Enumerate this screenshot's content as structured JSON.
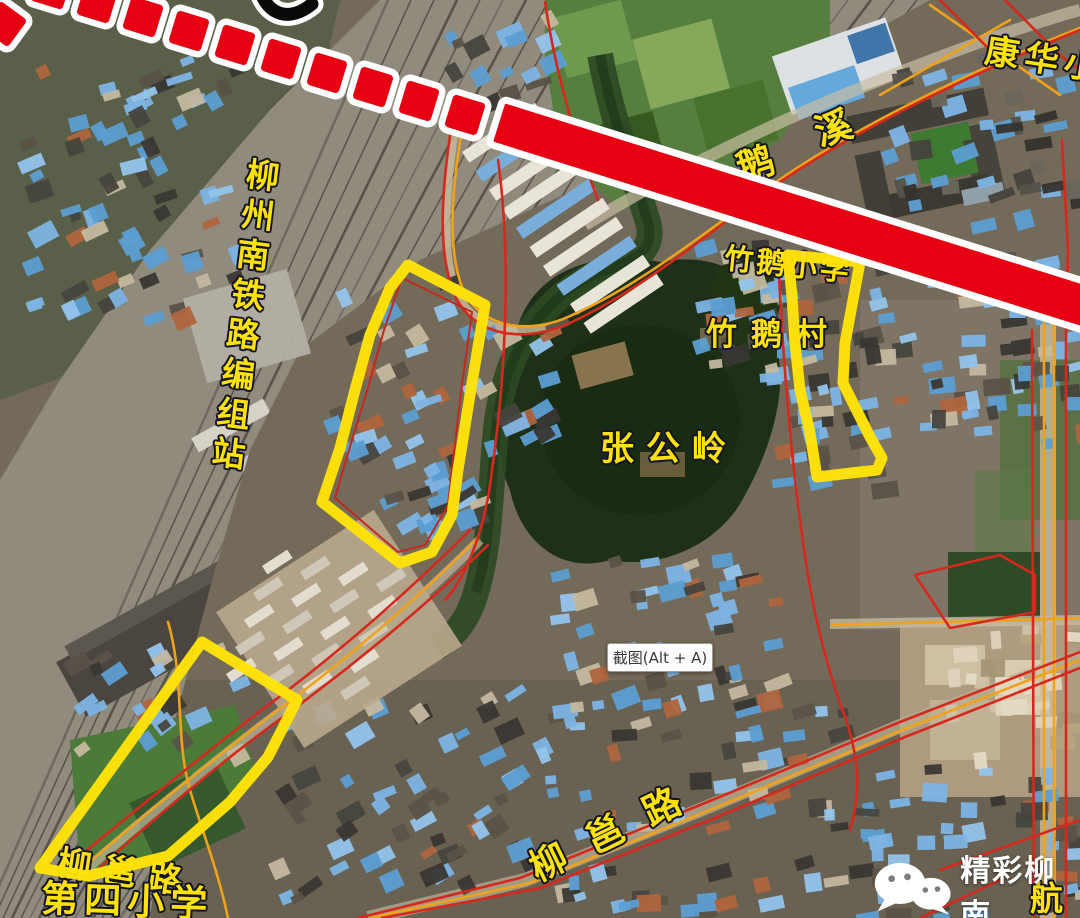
{
  "map": {
    "labels": {
      "marshalling_station": "柳州南铁路编组站",
      "zhanggongling": "张公岭",
      "zhue_village": "竹鹅村",
      "zhue_school": "竹鹅小学",
      "exi_char1": "鹅",
      "exi_char2": "溪",
      "kanghua": "康华小",
      "liuyong_road": "柳邕路",
      "fourth_school_line1": "柳邕路",
      "fourth_school_line2": "第四小学",
      "hang_road": "航"
    },
    "colors": {
      "highlight_region": "#ffe308",
      "rail_line": "#e70012",
      "boundary_red": "#d6281c",
      "road_orange": "#efa21a",
      "label_yellow": "#ffe308"
    }
  },
  "overlay": {
    "screenshot_button": "截图(Alt + A)"
  },
  "watermark": {
    "text": "精彩柳南"
  }
}
